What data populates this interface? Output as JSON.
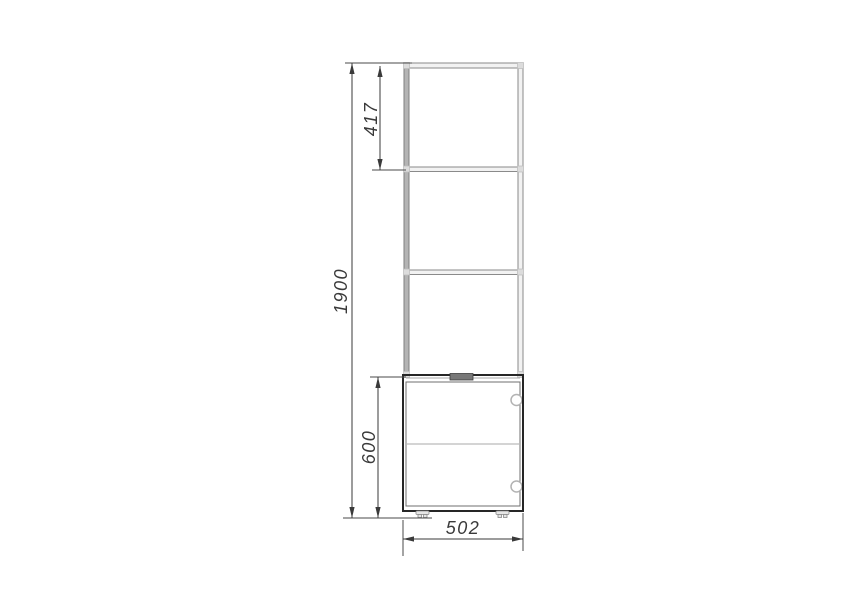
{
  "dimensions": {
    "total_height": "1900",
    "upper_section": "417",
    "lower_section": "600",
    "width": "502"
  },
  "colors": {
    "background": "#ffffff",
    "upper_unit_lines": "#8a8a8a",
    "lower_cabinet_lines": "#262626",
    "dimension_lines": "#3a3a3a",
    "handle_fill": "#787878",
    "hinge_stroke": "#b3b3b3"
  }
}
